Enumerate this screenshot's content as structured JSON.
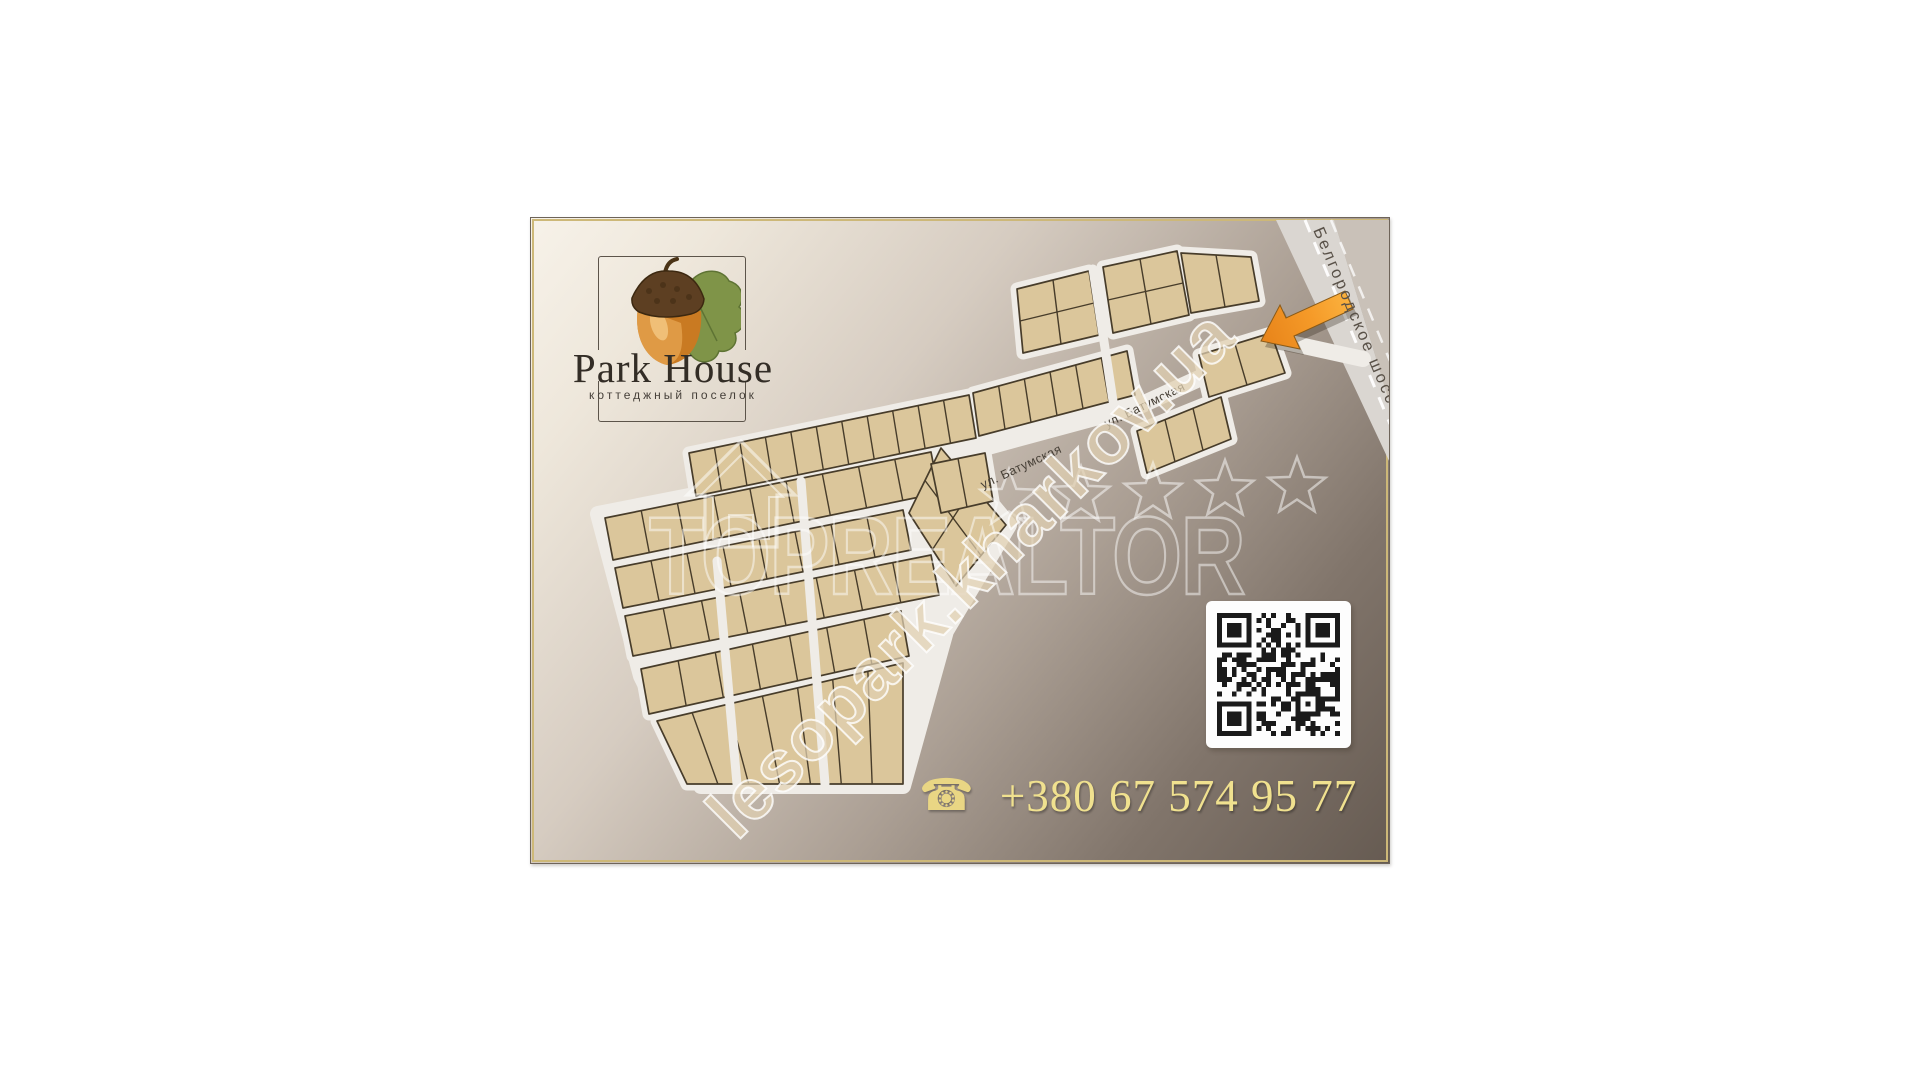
{
  "brand": {
    "name": "Park House",
    "tagline": "коттеджный поселок",
    "logo_icon": "acorn-with-oak-leaf"
  },
  "map": {
    "street_label": "ул. Батумская",
    "street_label_2": "ул. Батумская",
    "highway_label": "Белгородское шоссе",
    "entrance_marker": "orange-arrow"
  },
  "watermark": {
    "realtor": "TOPREALTOR",
    "site": "lesopark.kharkov.ua",
    "stars": 5,
    "house_icon": "house-outline-icon"
  },
  "contact": {
    "phone": "+380 67 574 95 77",
    "phone_icon": "telephone"
  },
  "colors": {
    "accent_orange": "#f59a28",
    "phone_gold": "#f0e18f",
    "plot_fill": "#dbc69b",
    "plot_stroke": "#473c2a",
    "street": "#efece7",
    "highway": "#dad6d1",
    "card_border_gold": "#cdb878",
    "card_bg_light": "#f7f2e9",
    "card_bg_dark": "#665b52",
    "qr_dark": "#1a1a1a"
  }
}
